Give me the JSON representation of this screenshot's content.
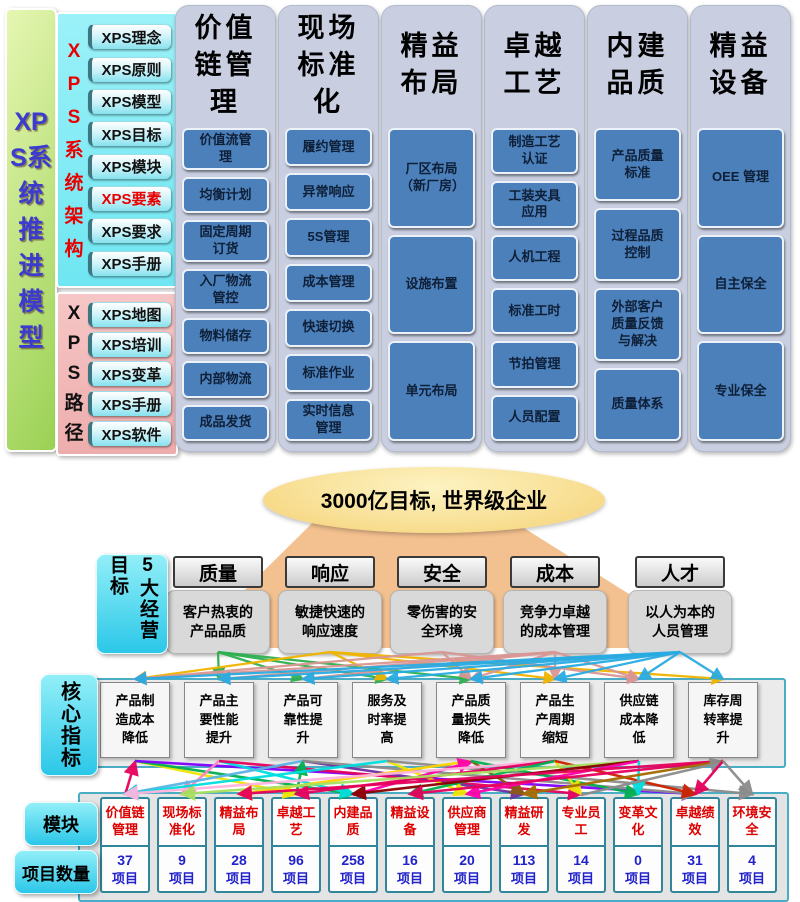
{
  "left_bar": {
    "title": "XPS系统推进模型"
  },
  "xps_architecture": {
    "label": "XPS系统架构",
    "items": [
      {
        "label": "XPS理念",
        "highlight": false
      },
      {
        "label": "XPS原则",
        "highlight": false
      },
      {
        "label": "XPS模型",
        "highlight": false
      },
      {
        "label": "XPS目标",
        "highlight": false
      },
      {
        "label": "XPS模块",
        "highlight": false
      },
      {
        "label": "XPS要素",
        "highlight": true
      },
      {
        "label": "XPS要求",
        "highlight": false
      },
      {
        "label": "XPS手册",
        "highlight": false
      }
    ]
  },
  "xps_path": {
    "label": "XPS路径",
    "items": [
      "XPS地图",
      "XPS培训",
      "XPS变革",
      "XPS手册",
      "XPS软件"
    ]
  },
  "pillars": [
    {
      "title": "价值链管理",
      "items": [
        "价值流管理",
        "均衡计划",
        "固定周期订货",
        "入厂物流管控",
        "物料储存",
        "内部物流",
        "成品发货"
      ]
    },
    {
      "title": "现场标准化",
      "items": [
        "履约管理",
        "异常响应",
        "5S管理",
        "成本管理",
        "快速切换",
        "标准作业",
        "实时信息管理"
      ]
    },
    {
      "title": "精益布局",
      "items": [
        "厂区布局（新厂房）",
        "设施布置",
        "单元布局"
      ]
    },
    {
      "title": "卓越工艺",
      "items": [
        "制造工艺认证",
        "工装夹具应用",
        "人机工程",
        "标准工时",
        "节拍管理",
        "人员配置"
      ]
    },
    {
      "title": "内建品质",
      "items": [
        "产品质量标准",
        "过程品质控制",
        "外部客户质量反馈与解决",
        "质量体系"
      ]
    },
    {
      "title": "精益设备",
      "items": [
        "OEE 管理",
        "自主保全",
        "专业保全"
      ]
    }
  ],
  "vision": {
    "label": "3000亿目标, 世界级企业"
  },
  "goals": {
    "label": "5大经营目标",
    "items": [
      {
        "title": "质量",
        "desc": "客户热衷的产品品质"
      },
      {
        "title": "响应",
        "desc": "敏捷快速的响应速度"
      },
      {
        "title": "安全",
        "desc": "零伤害的安全环境"
      },
      {
        "title": "成本",
        "desc": "竞争力卓越的成本管理"
      },
      {
        "title": "人才",
        "desc": "以人为本的人员管理"
      }
    ]
  },
  "indicators": {
    "label": "核心指标",
    "items": [
      "产品制造成本降低",
      "产品主要性能提升",
      "产品可靠性提升",
      "服务及时率提高",
      "产品质量损失降低",
      "产品生产周期缩短",
      "供应链成本降低",
      "库存周转率提升"
    ]
  },
  "modules": {
    "row_label": "模块",
    "count_label": "项目数量",
    "unit": "项目",
    "items": [
      {
        "name": "价值链管理",
        "count": "37"
      },
      {
        "name": "现场标准化",
        "count": "9"
      },
      {
        "name": "精益布局",
        "count": "28"
      },
      {
        "name": "卓越工艺",
        "count": "96"
      },
      {
        "name": "内建品质",
        "count": "258"
      },
      {
        "name": "精益设备",
        "count": "16"
      },
      {
        "name": "供应商管理",
        "count": "20"
      },
      {
        "name": "精益研发",
        "count": "113"
      },
      {
        "name": "专业员工",
        "count": "14"
      },
      {
        "name": "变革文化",
        "count": "0"
      },
      {
        "name": "卓越绩效",
        "count": "31"
      },
      {
        "name": "环境安全",
        "count": "4"
      }
    ]
  },
  "connections": {
    "goal_colors": [
      "#2eb050",
      "#f0b400",
      "#d99694",
      "#d99694",
      "#29abe2"
    ],
    "goals_to_indicators": [
      {
        "from": 0,
        "to": [
          1,
          2,
          3,
          4
        ]
      },
      {
        "from": 1,
        "to": [
          0,
          3,
          5,
          7
        ]
      },
      {
        "from": 2,
        "to": [
          0,
          4,
          6
        ]
      },
      {
        "from": 3,
        "to": [
          0,
          1,
          2,
          4,
          5,
          6
        ]
      },
      {
        "from": 4,
        "to": [
          0,
          1,
          2,
          3,
          4,
          5,
          6,
          7
        ]
      }
    ],
    "indicators_to_modules": [
      [
        0,
        0,
        "#e6005c",
        "up"
      ],
      [
        0,
        3,
        "#f0e400",
        "down"
      ],
      [
        0,
        4,
        "#00b050",
        "down"
      ],
      [
        0,
        10,
        "#8000ff",
        "down"
      ],
      [
        1,
        1,
        "#ff85c2",
        "down"
      ],
      [
        1,
        4,
        "#00dede",
        "down"
      ],
      [
        1,
        8,
        "#e6005c",
        "down"
      ],
      [
        2,
        0,
        "#5ab4e5",
        "down"
      ],
      [
        2,
        3,
        "#00b050",
        "up"
      ],
      [
        2,
        7,
        "#7030a0",
        "down"
      ],
      [
        2,
        10,
        "#8c8c8c",
        "down"
      ],
      [
        3,
        0,
        "#00dede",
        "down"
      ],
      [
        3,
        6,
        "#f0e400",
        "down"
      ],
      [
        3,
        11,
        "#8c8c8c",
        "down"
      ],
      [
        4,
        2,
        "#ffd400",
        "down"
      ],
      [
        4,
        4,
        "#ff00aa",
        "up"
      ],
      [
        4,
        7,
        "#8b5a13",
        "down"
      ],
      [
        4,
        9,
        "#00b050",
        "down"
      ],
      [
        5,
        0,
        "#ffb3de",
        "down"
      ],
      [
        5,
        3,
        "#e6005c",
        "down"
      ],
      [
        5,
        5,
        "#00b050",
        "down"
      ],
      [
        5,
        8,
        "#f0e400",
        "down"
      ],
      [
        5,
        10,
        "#cc2200",
        "down"
      ],
      [
        6,
        1,
        "#a8e05f",
        "down"
      ],
      [
        6,
        4,
        "#8b0000",
        "down"
      ],
      [
        6,
        6,
        "#ff00aa",
        "down"
      ],
      [
        6,
        9,
        "#00dede",
        "down"
      ],
      [
        7,
        2,
        "#e6005c",
        "down"
      ],
      [
        7,
        5,
        "#e6005c",
        "down"
      ],
      [
        7,
        7,
        "#a56a00",
        "down"
      ],
      [
        7,
        8,
        "#8c8c8c",
        "up"
      ],
      [
        7,
        10,
        "#e6005c",
        "down"
      ],
      [
        7,
        11,
        "#8c8c8c",
        "down"
      ]
    ]
  }
}
